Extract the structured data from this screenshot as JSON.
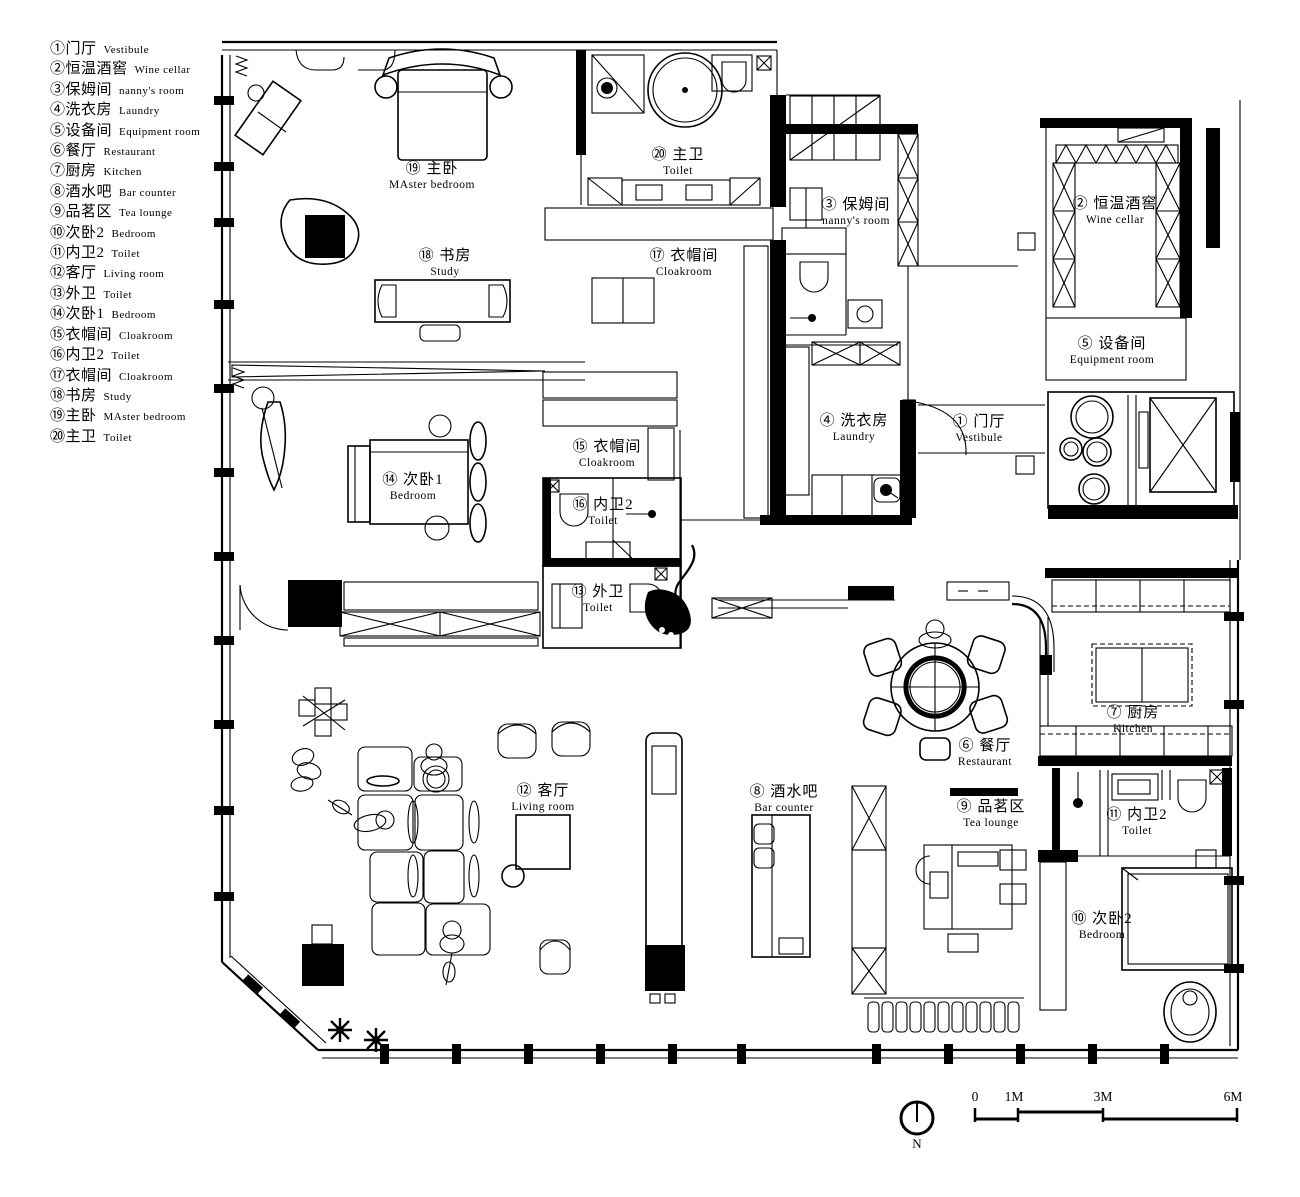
{
  "colors": {
    "ink": "#000000",
    "paper": "#ffffff"
  },
  "legend": {
    "items": [
      {
        "zh": "①门厅",
        "en": "Vestibule"
      },
      {
        "zh": "②恒温酒窖",
        "en": "Wine cellar"
      },
      {
        "zh": "③保姆间",
        "en": "nanny's room"
      },
      {
        "zh": "④洗衣房",
        "en": "Laundry"
      },
      {
        "zh": "⑤设备间",
        "en": "Equipment room"
      },
      {
        "zh": "⑥餐厅",
        "en": "Restaurant"
      },
      {
        "zh": "⑦厨房",
        "en": "Kitchen"
      },
      {
        "zh": "⑧酒水吧",
        "en": "Bar counter"
      },
      {
        "zh": "⑨品茗区",
        "en": "Tea lounge"
      },
      {
        "zh": "⑩次卧2",
        "en": "Bedroom"
      },
      {
        "zh": "⑪内卫2",
        "en": "Toilet"
      },
      {
        "zh": "⑫客厅",
        "en": "Living room"
      },
      {
        "zh": "⑬外卫",
        "en": "Toilet"
      },
      {
        "zh": "⑭次卧1",
        "en": "Bedroom"
      },
      {
        "zh": "⑮衣帽间",
        "en": "Cloakroom"
      },
      {
        "zh": "⑯内卫2",
        "en": "Toilet"
      },
      {
        "zh": "⑰衣帽间",
        "en": "Cloakroom"
      },
      {
        "zh": "⑱书房",
        "en": "Study"
      },
      {
        "zh": "⑲主卧",
        "en": "MAster bedroom"
      },
      {
        "zh": "⑳主卫",
        "en": "Toilet"
      }
    ]
  },
  "rooms": [
    {
      "zh": "① 门厅",
      "en": "Vestibule"
    },
    {
      "zh": "② 恒温酒窖",
      "en": "Wine cellar"
    },
    {
      "zh": "③ 保姆间",
      "en": "nanny's room"
    },
    {
      "zh": "④ 洗衣房",
      "en": "Laundry"
    },
    {
      "zh": "⑤ 设备间",
      "en": "Equipment room"
    },
    {
      "zh": "⑥ 餐厅",
      "en": "Restaurant"
    },
    {
      "zh": "⑦ 厨房",
      "en": "Kitchen"
    },
    {
      "zh": "⑧ 酒水吧",
      "en": "Bar counter"
    },
    {
      "zh": "⑨ 品茗区",
      "en": "Tea lounge"
    },
    {
      "zh": "⑩ 次卧2",
      "en": "Bedroom"
    },
    {
      "zh": "⑪ 内卫2",
      "en": "Toilet"
    },
    {
      "zh": "⑫ 客厅",
      "en": "Living room"
    },
    {
      "zh": "⑬ 外卫",
      "en": "Toilet"
    },
    {
      "zh": "⑭ 次卧1",
      "en": "Bedroom"
    },
    {
      "zh": "⑮ 衣帽间",
      "en": "Cloakroom"
    },
    {
      "zh": "⑯ 内卫2",
      "en": "Toilet"
    },
    {
      "zh": "⑰ 衣帽间",
      "en": "Cloakroom"
    },
    {
      "zh": "⑱ 书房",
      "en": "Study"
    },
    {
      "zh": "⑲ 主卧",
      "en": "MAster bedroom"
    },
    {
      "zh": "⑳ 主卫",
      "en": "Toilet"
    }
  ],
  "scalebar": {
    "ticks": [
      "0",
      "1M",
      "3M",
      "6M"
    ]
  },
  "north": {
    "label": "N"
  }
}
